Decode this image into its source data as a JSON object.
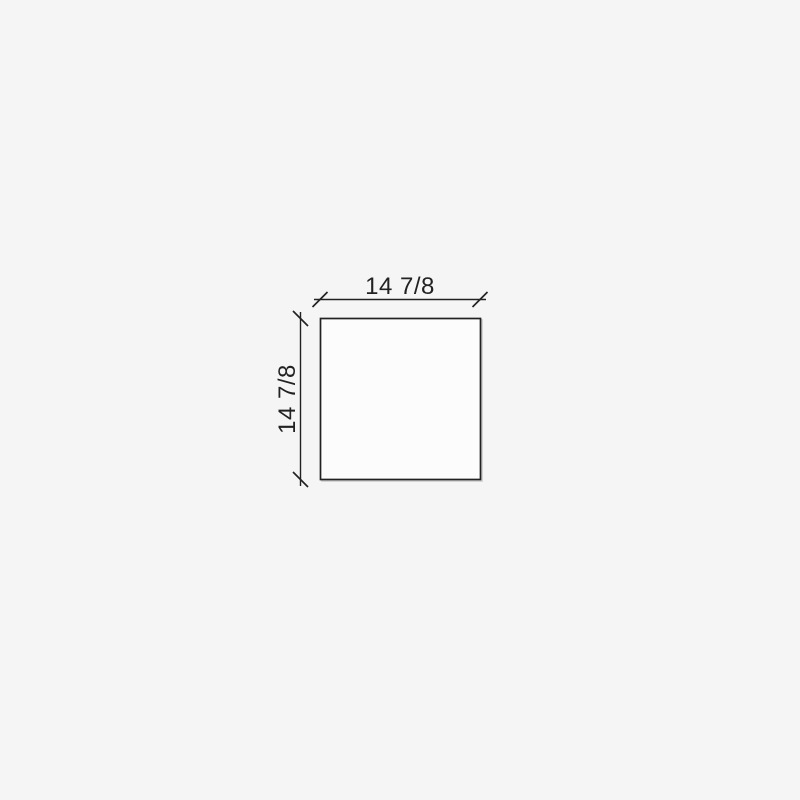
{
  "drawing": {
    "dimensions": {
      "width_label": "14 7/8",
      "height_label": "14 7/8"
    },
    "colors": {
      "background": "#f5f5f6",
      "line": "#222222",
      "panel_fill": "#fcfcfc",
      "shadow": "#cbcbcb"
    }
  }
}
